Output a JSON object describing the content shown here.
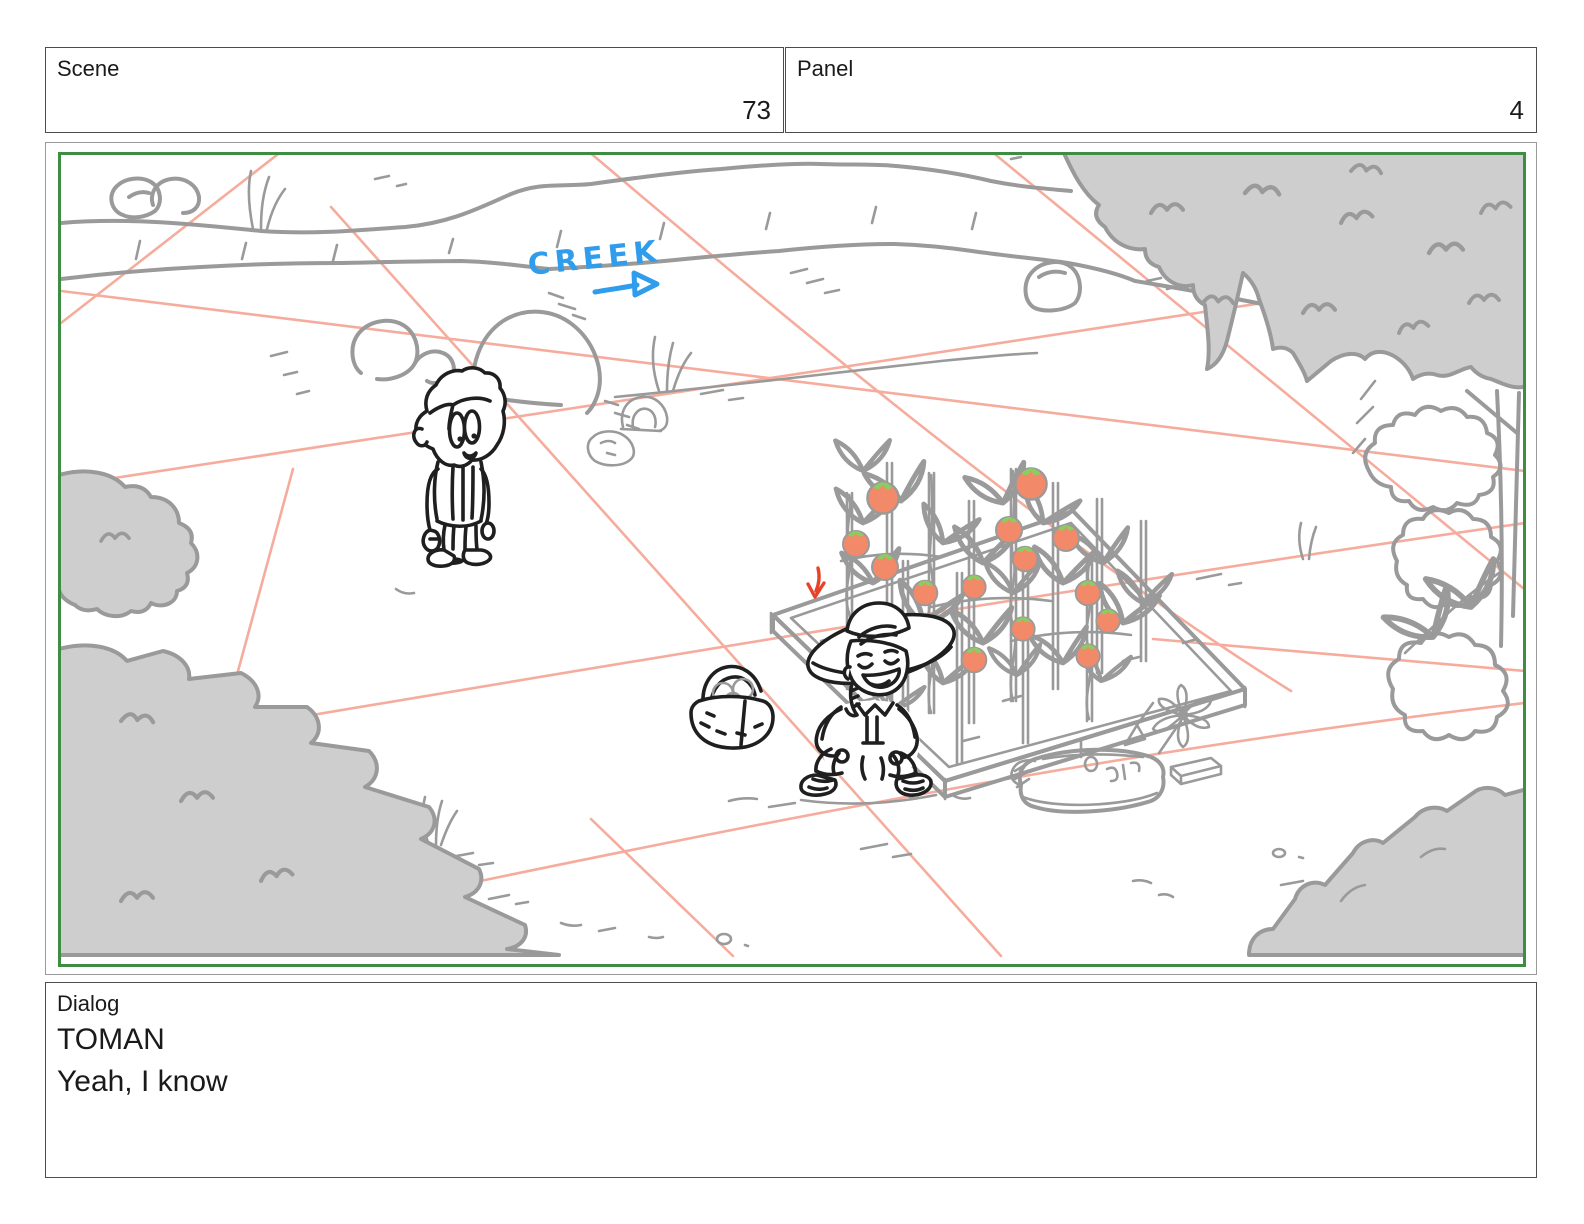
{
  "header": {
    "scene_label": "Scene",
    "scene_value": "73",
    "panel_label": "Panel",
    "panel_value": "4"
  },
  "dialog": {
    "label": "Dialog",
    "character": "TOMAN",
    "line": "Yeah, I know"
  },
  "sketch": {
    "creek_label": "CREEK",
    "colors": {
      "frame_green": "#3e8e41",
      "grid_pink": "#f6ac9d",
      "sketch_gray": "#9a9a9a",
      "foliage_fill": "#cecece",
      "ink_black": "#1f1f1f",
      "creek_blue": "#2f9cec",
      "arrow_red": "#e8432a",
      "tomato": "#f28a6a",
      "tomato_leaf": "#8bcd61"
    },
    "elements": [
      "creek banks with flow label and arrow",
      "salmon perspective grid",
      "worried kid standing on path",
      "gardener kid in sun hat crouching",
      "harvest basket with tomatoes",
      "raised planter bed with staked tomato plants",
      "fertilizer bag, pinwheel, brick",
      "gray tree canopy and bushes"
    ]
  }
}
